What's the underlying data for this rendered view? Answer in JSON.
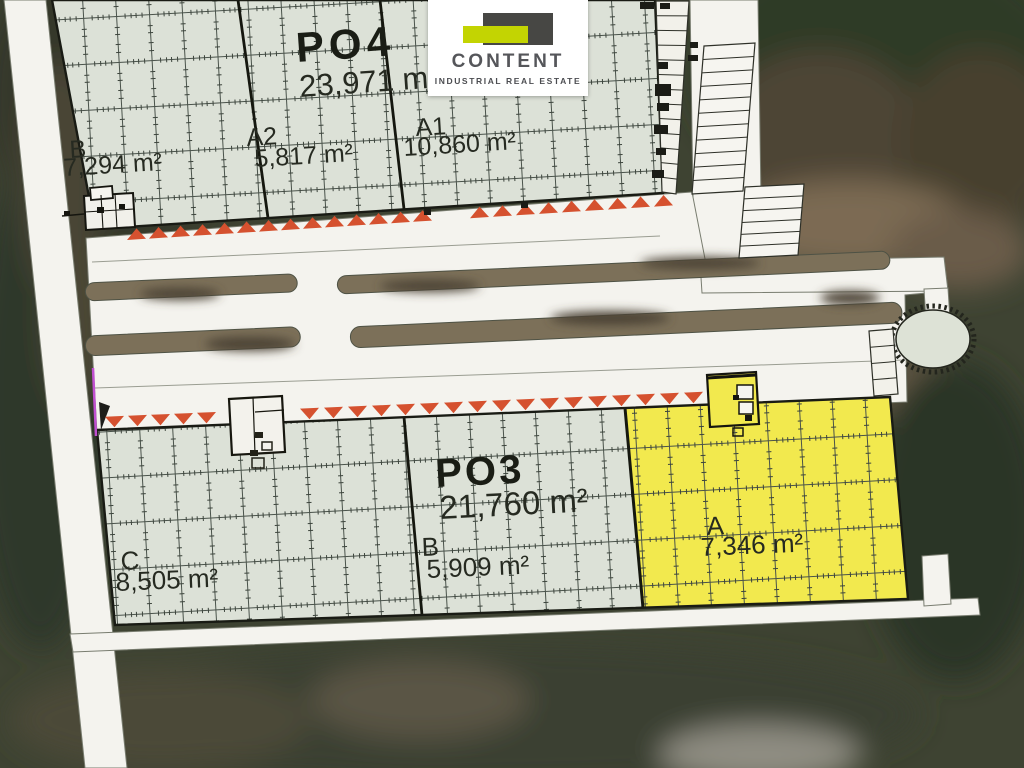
{
  "logo": {
    "name": "CONTENT",
    "tagline": "INDUSTRIAL REAL ESTATE"
  },
  "site": {
    "po4": {
      "id": "PO4",
      "area": "23,971 m²",
      "sections": [
        {
          "label": "B",
          "area": "7,294 m²"
        },
        {
          "label": "A2",
          "area": "5,817 m²"
        },
        {
          "label": "A1",
          "area": "10,860 m²"
        }
      ]
    },
    "po3": {
      "id": "PO3",
      "area": "21,760 m²",
      "sections": [
        {
          "label": "C",
          "area": "8,505 m²"
        },
        {
          "label": "B",
          "area": "5,909 m²"
        },
        {
          "label": "A",
          "area": "7,346 m²",
          "highlighted": true
        }
      ]
    }
  },
  "colors": {
    "building": "#dce1d7",
    "highlight": "#f2e94e",
    "dock_marker": "#d5512f",
    "road": "#f4f3ee",
    "logo_accent": "#c3d402",
    "boundary_marker": "#c04fd0"
  }
}
